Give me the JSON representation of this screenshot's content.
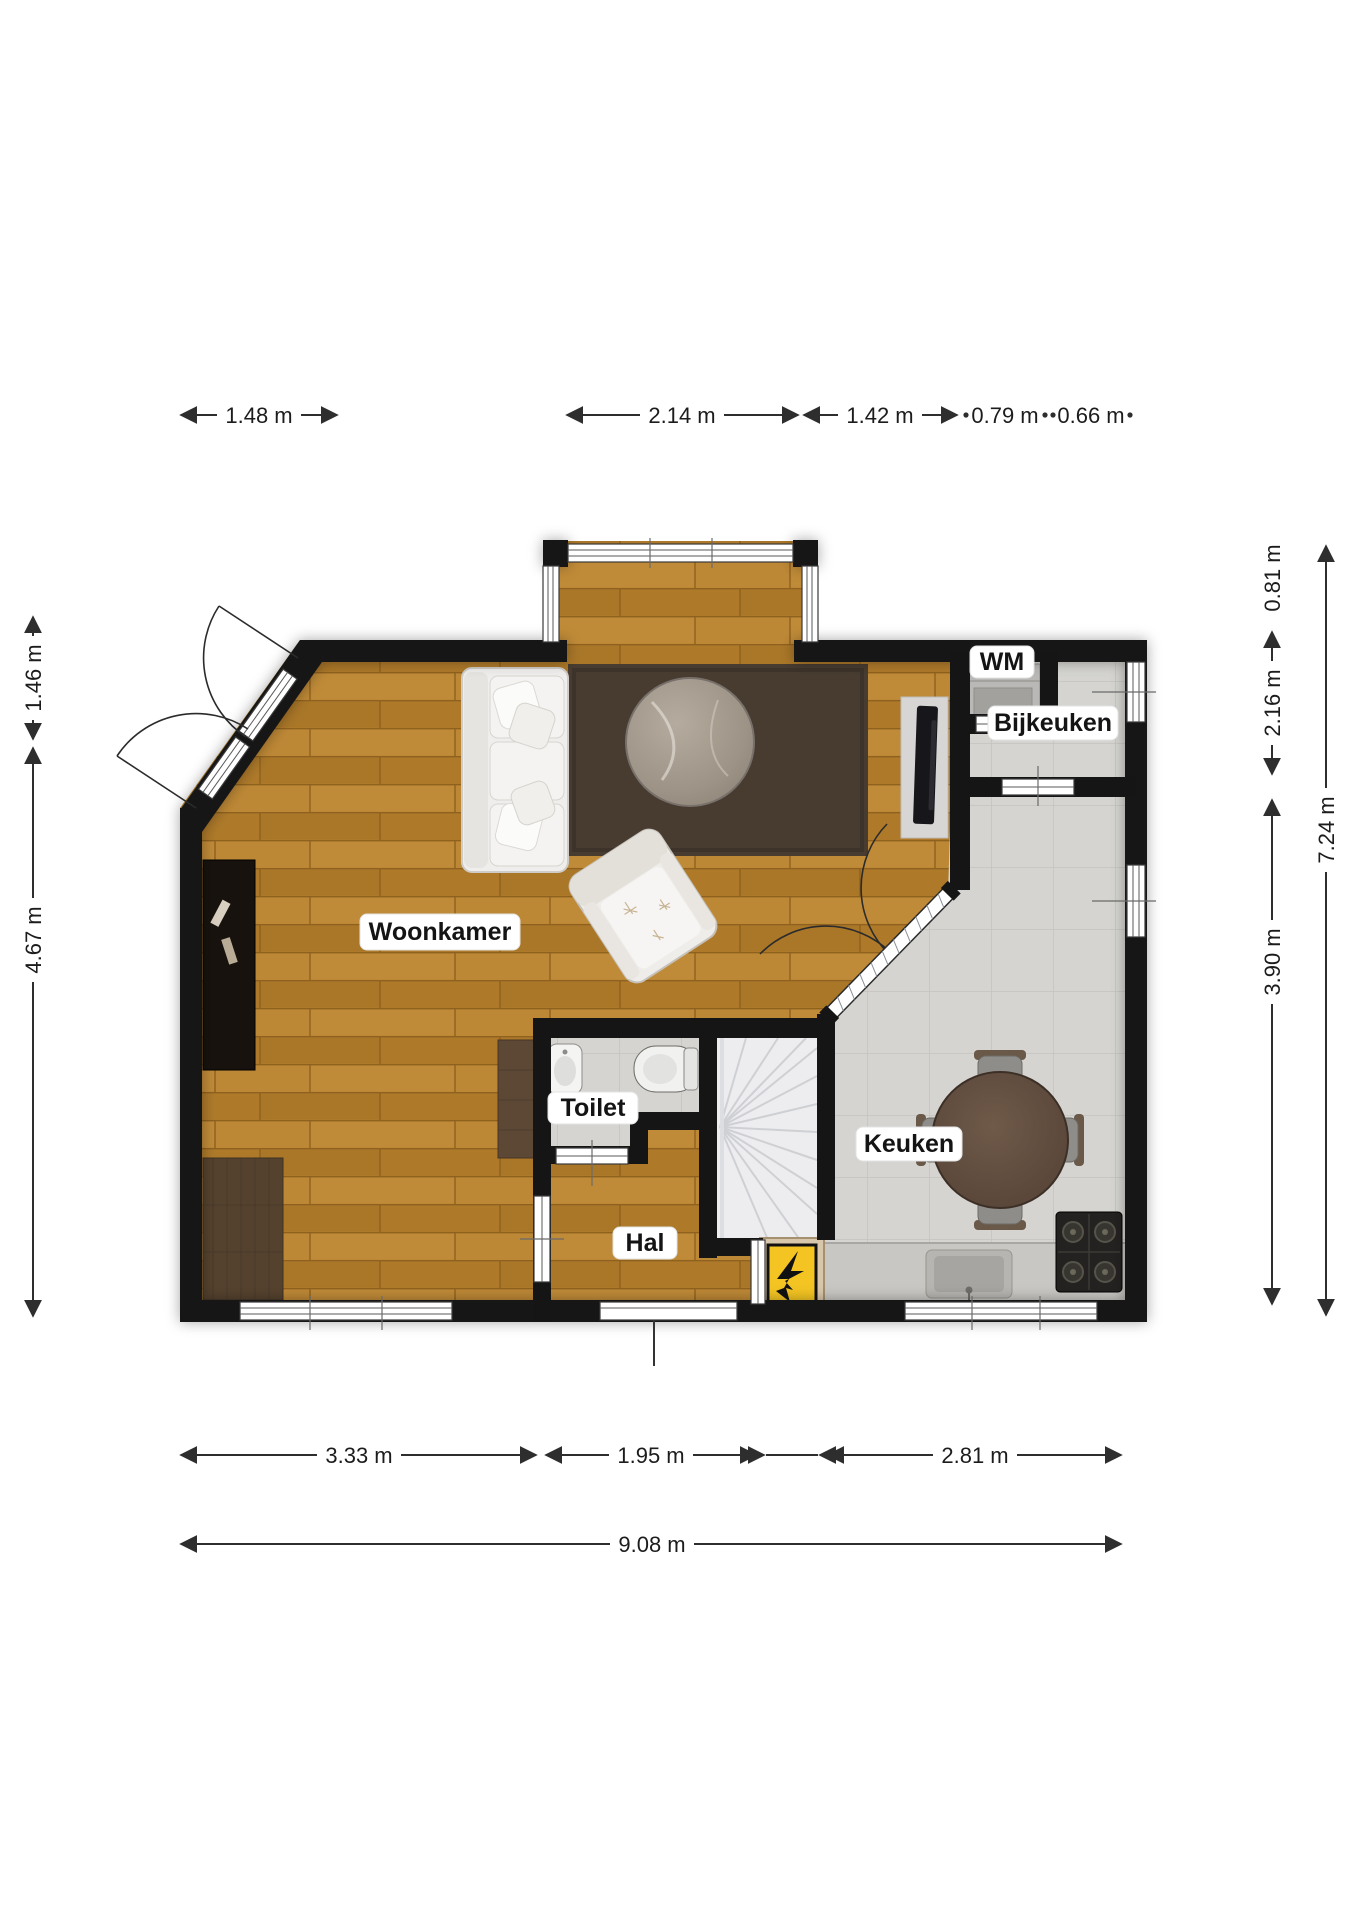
{
  "rooms": {
    "living": {
      "label": "Woonkamer"
    },
    "utility": {
      "label": "Bijkeuken"
    },
    "wm": {
      "label": "WM"
    },
    "kitchen": {
      "label": "Keuken"
    },
    "toilet": {
      "label": "Toilet"
    },
    "hall": {
      "label": "Hal"
    }
  },
  "dimensions": {
    "top": [
      "1.48 m",
      "2.14 m",
      "1.42 m",
      "0.79 m",
      "0.66 m"
    ],
    "left": [
      "1.46 m",
      "4.67 m"
    ],
    "right": [
      "0.81 m",
      "2.16 m",
      "3.90 m",
      "7.24 m"
    ],
    "bottom": [
      "3.33 m",
      "1.95 m",
      "2.81 m",
      "9.08 m"
    ]
  },
  "icons": {
    "electric_panel": "lightning-bolt-icon"
  },
  "colors": {
    "wall": "#151515",
    "wood_floor": "#b6802e",
    "tile_floor": "#d5d4d0",
    "stairs": "#ededef",
    "rug": "#483c30",
    "panel_yellow": "#f3c422"
  }
}
